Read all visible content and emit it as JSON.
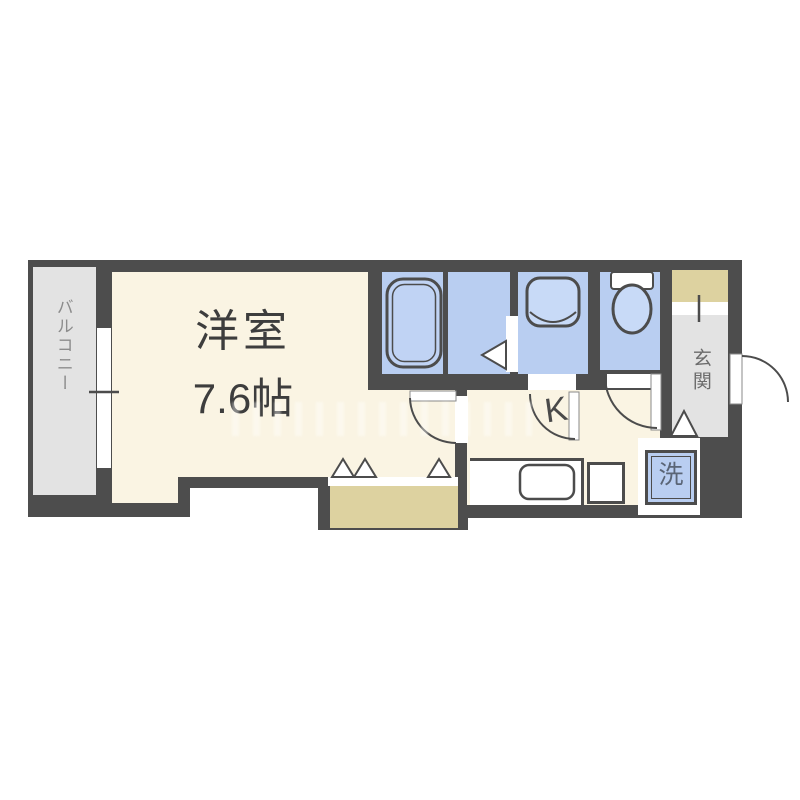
{
  "floorplan": {
    "type_hint": "apartment floor plan",
    "rooms": {
      "main_room": {
        "name": "洋室",
        "size": "7.6帖"
      },
      "balcony": {
        "label": "バルコニー"
      },
      "entrance": {
        "label": "玄関"
      },
      "kitchen": {
        "label": "K"
      },
      "laundry": {
        "label": "洗"
      }
    },
    "fixtures": [
      "bathtub",
      "bathroom-floor",
      "washbasin-sink",
      "toilet",
      "kitchen-counter-sink",
      "burner",
      "washing-machine-space",
      "closet-folding-doors",
      "entrance-step",
      "sliding-window",
      "entry-door"
    ],
    "colors": {
      "wall": "#4d4d4d",
      "floor_cream": "#faf4e3",
      "wet_area_blue": "#b9cef1",
      "fixture_blue": "#c8daf7",
      "balcony_gray": "#e3e3e3",
      "closet_tan": "#ddd2a0",
      "text_dark": "#3d3d3d",
      "text_gray": "#8c8c8c"
    }
  }
}
